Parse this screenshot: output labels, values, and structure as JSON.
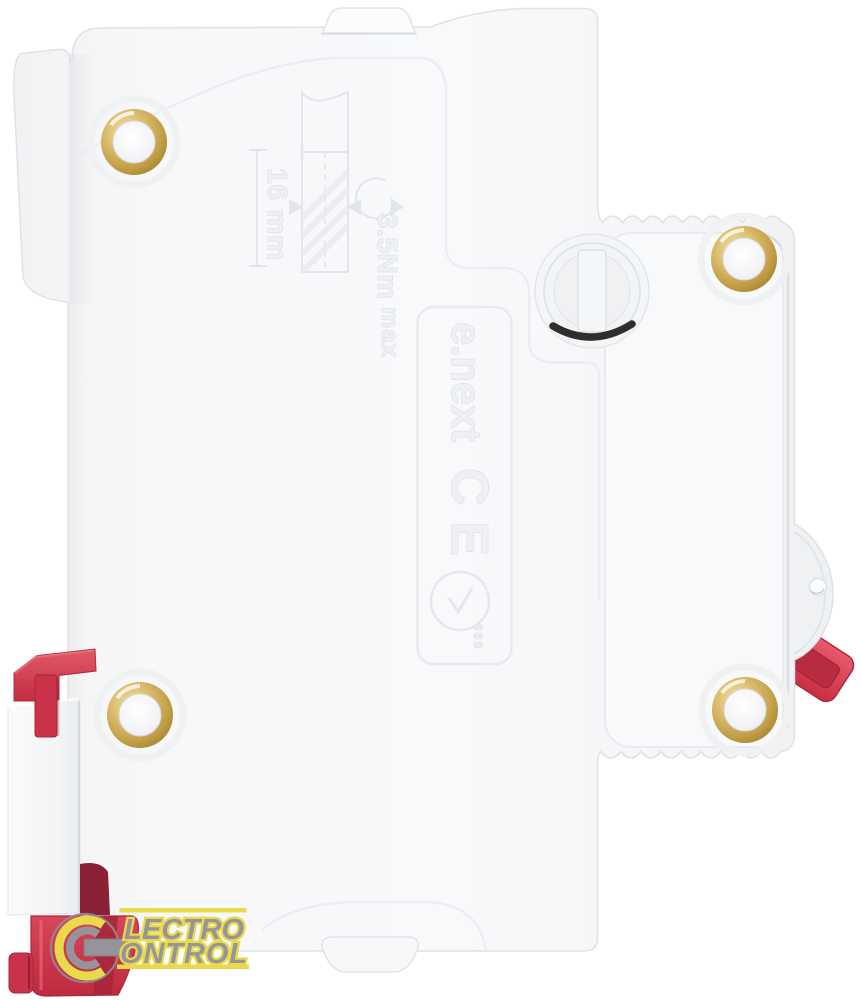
{
  "photo": {
    "subject": "single-pole modular circuit breaker, side view product photo",
    "markings": {
      "strip_length": "16 mm",
      "torque": "3.5Nm",
      "torque_qualifier": "max",
      "brand": "e.next",
      "ce_mark": "CE",
      "cert_code": "060"
    },
    "colors": {
      "background": "#ffffff",
      "body": "#f6f7f8",
      "edge_shadow": "#dfe2e5",
      "emboss_line": "#e6e9ec",
      "red_lever": "#cf3a4e",
      "red_dark": "#a52639",
      "brass": "#c9a84d",
      "screw_slot_shadow": "#2f2e2f",
      "logo_yellow": "#e8da4b",
      "logo_gray": "#97949b"
    }
  },
  "watermark": {
    "glyph": "e",
    "line1": "LECTRO",
    "line2": "ONTROL"
  }
}
